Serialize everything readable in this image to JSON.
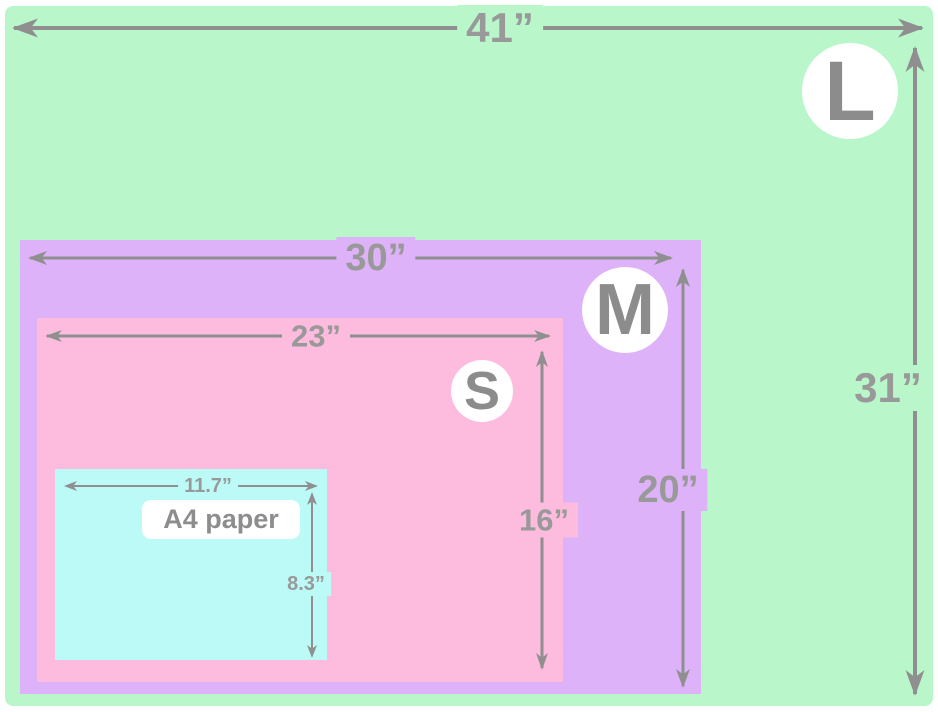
{
  "diagram": {
    "description": "Nested size comparison of blanket/board sizes L, M, S versus A4 paper",
    "sizes": [
      {
        "code": "L",
        "width_label": "41”",
        "height_label": "31”"
      },
      {
        "code": "M",
        "width_label": "30”",
        "height_label": "20”"
      },
      {
        "code": "S",
        "width_label": "23”",
        "height_label": "16”"
      },
      {
        "code": "A4",
        "name": "A4 paper",
        "width_label": "11.7”",
        "height_label": "8.3”"
      }
    ],
    "colors": {
      "l_area": "#b9f7cb",
      "m_area": "#ddb2f9",
      "s_area": "#fdbcdd",
      "a4_area": "#bcfaf8",
      "dimension_gray": "#8f8f8f",
      "badge_background": "#ffffff"
    }
  }
}
